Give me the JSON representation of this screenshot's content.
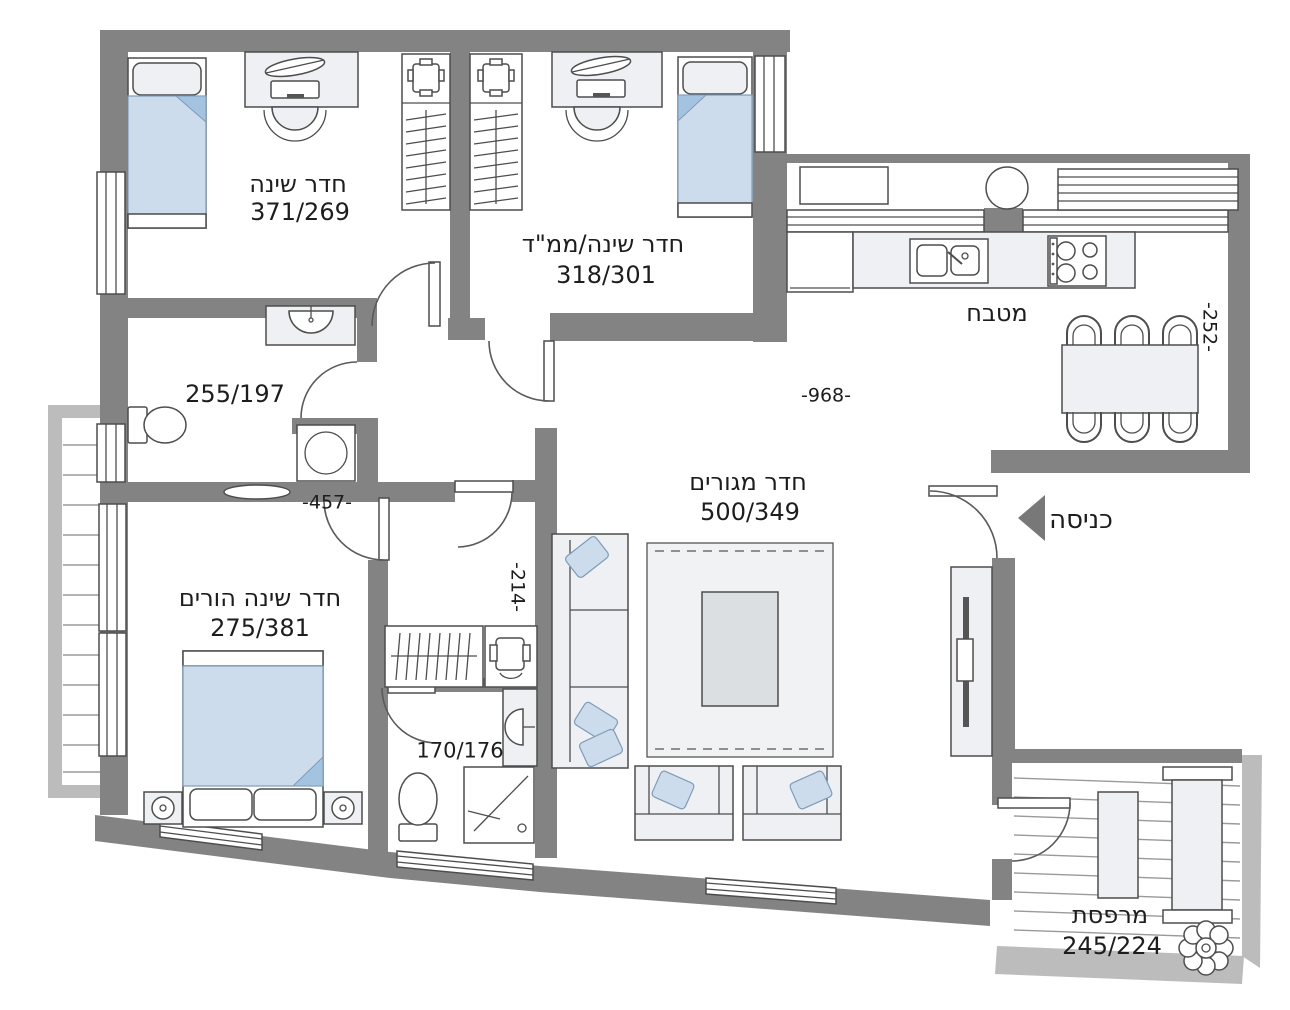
{
  "plan_type": "apartment-floor-plan",
  "rooms": {
    "bedroom1": {
      "name": "חדר שינה",
      "size": "371/269"
    },
    "bedroom2": {
      "name": "חדר שינה/ממ\"ד",
      "size": "318/301"
    },
    "kitchen": {
      "name": "מטבח"
    },
    "bathroom": {
      "size": "255/197"
    },
    "living": {
      "name": "חדר מגורים",
      "size": "500/349"
    },
    "master": {
      "name": "חדר שינה הורים",
      "size": "275/381"
    },
    "ensuite": {
      "size": "170/176"
    },
    "balcony": {
      "name": "מרפסת",
      "size": "245/224"
    },
    "entrance": {
      "name": "כניסה"
    }
  },
  "dimensions": {
    "living_width": "-968-",
    "kitchen_depth": "-252-",
    "bathroom_wall": "-457-",
    "corridor_width": "-214-"
  },
  "furniture_icons": [
    "single-bed",
    "double-bed",
    "desk-with-laptop",
    "office-chair",
    "wardrobe",
    "folded-clothes",
    "dining-table-6-chairs",
    "refrigerator",
    "double-sink",
    "stove-4-burners",
    "boiler",
    "ac-unit",
    "washing-machine",
    "toilet",
    "shower",
    "bathroom-sink",
    "sofa",
    "armchair",
    "rug",
    "coffee-table",
    "tv-unit",
    "nightstand-lamp",
    "bench",
    "lounge",
    "plant",
    "entrance-arrow",
    "door-arc",
    "window"
  ],
  "colors": {
    "wall": "#838383",
    "outer_rim": "#bcbcbc",
    "furniture": "#eef0f3",
    "fabric_blue": "#ccdcec",
    "fabric_blue_dark": "#a3c3e0",
    "text": "#1d1d1d"
  }
}
